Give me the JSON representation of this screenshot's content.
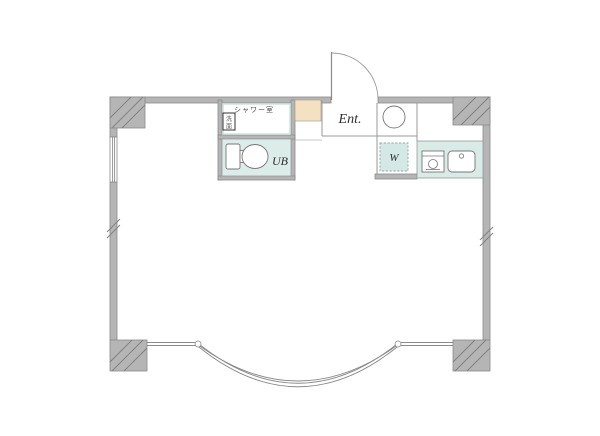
{
  "floorplan": {
    "labels": {
      "shower_room": "シャワー室",
      "washbasin_top": "洗",
      "washbasin_bottom": "面",
      "unit_bath": "UB",
      "entrance": "Ent.",
      "washer": "W"
    },
    "colors": {
      "wall_fill": "#b5b5b5",
      "wall_edge": "#8a8a8a",
      "partition_line": "#9a9a9a",
      "bath_fill": "#dcede9",
      "counter_fill": "#d8ebe7",
      "washer_fill": "#d4e9e5",
      "cabinet_fill": "#f3e1c1"
    }
  }
}
